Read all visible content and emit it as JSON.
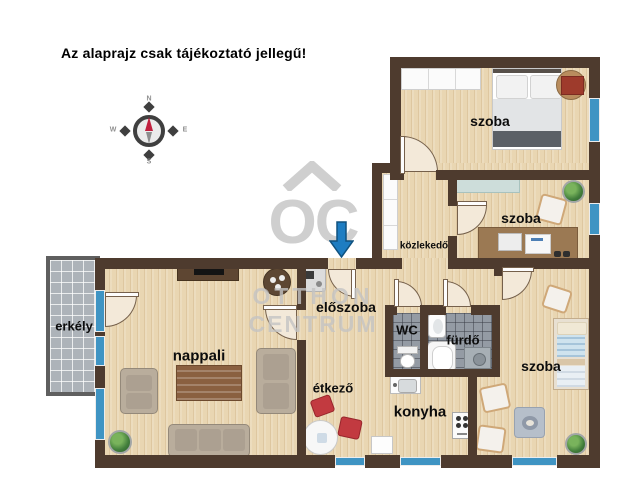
{
  "title": "Az alaprajz csak tájékoztató jellegű!",
  "compass": {
    "n": "N",
    "s": "S",
    "w": "W",
    "e": "E"
  },
  "watermark": {
    "monogram": "OC",
    "line1": "OTTHON",
    "line2": "CENTRUM"
  },
  "rooms": {
    "bedroom1": "szoba",
    "bedroom2": "szoba",
    "bedroom3": "szoba",
    "hallway": "közlekedő",
    "entry": "előszoba",
    "wc": "WC",
    "bathroom": "fürdő",
    "living": "nappali",
    "balcony": "erkély",
    "dining": "étkező",
    "kitchen": "konyha"
  },
  "colors": {
    "wall": "#4e3b2e",
    "window": "#3f94c3",
    "entry_arrow": "#1e7dc2",
    "wood_floor": "#e9d6b2",
    "bath_tile": "#949ba4",
    "balcony_tile": "#adb3b9",
    "compass_needle": "#c11f3e",
    "dining_chair": "#c23a40",
    "watermark": "#c4c4c4"
  }
}
